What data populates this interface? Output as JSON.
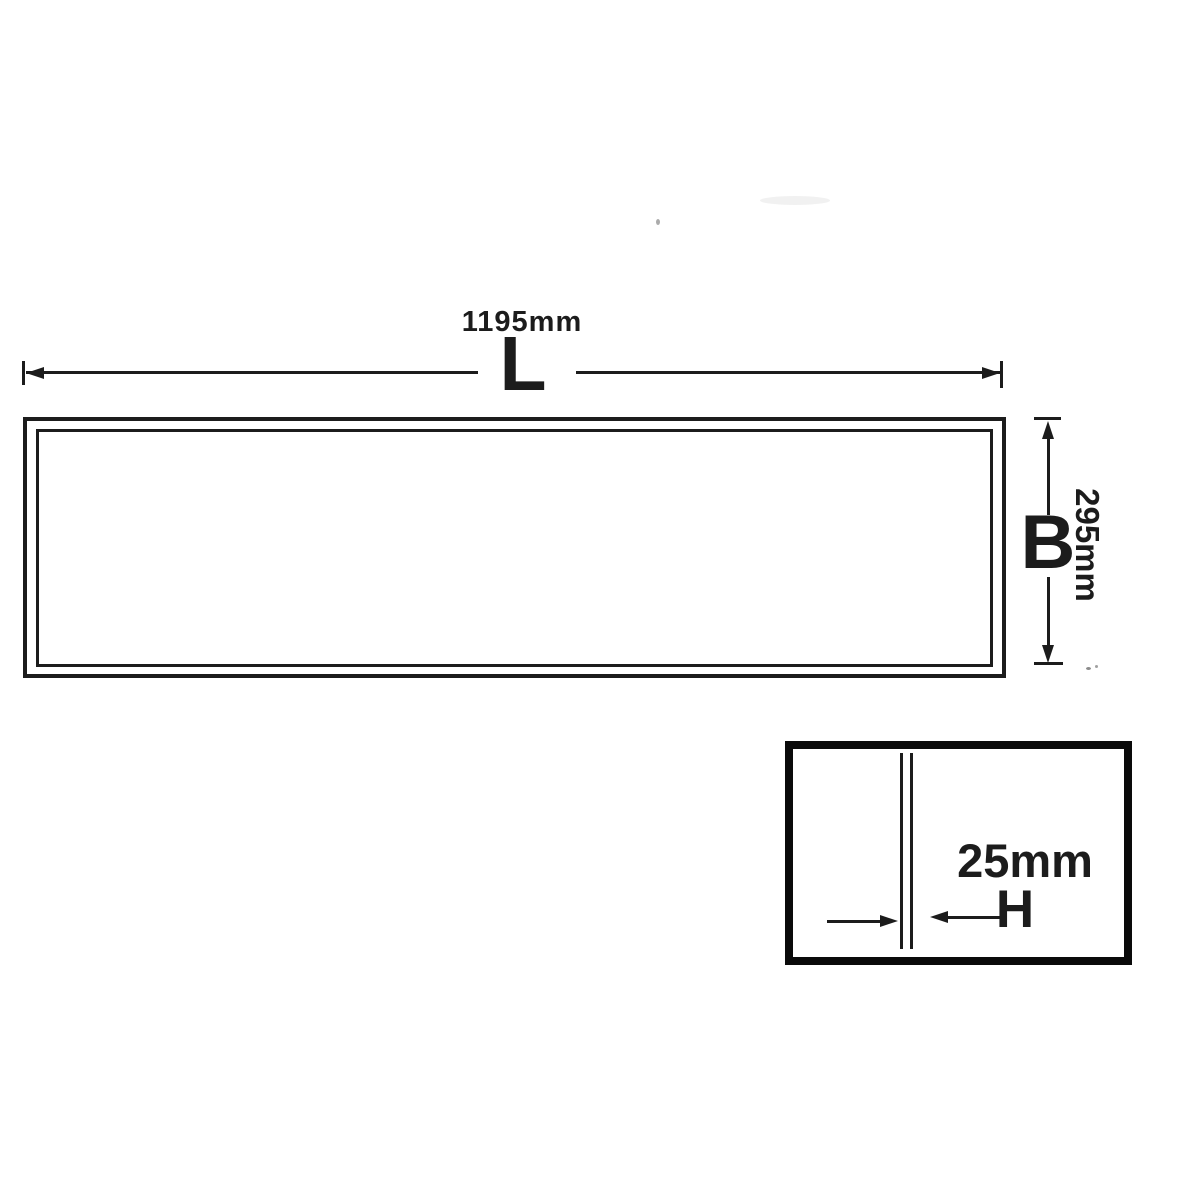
{
  "colors": {
    "ink": "#1c1c1c",
    "paper": "#ffffff"
  },
  "diagram": {
    "length": {
      "value": "1195mm",
      "symbol": "L"
    },
    "width": {
      "value": "295mm",
      "symbol": "B"
    },
    "thickness": {
      "value": "25mm",
      "symbol": "H"
    }
  }
}
